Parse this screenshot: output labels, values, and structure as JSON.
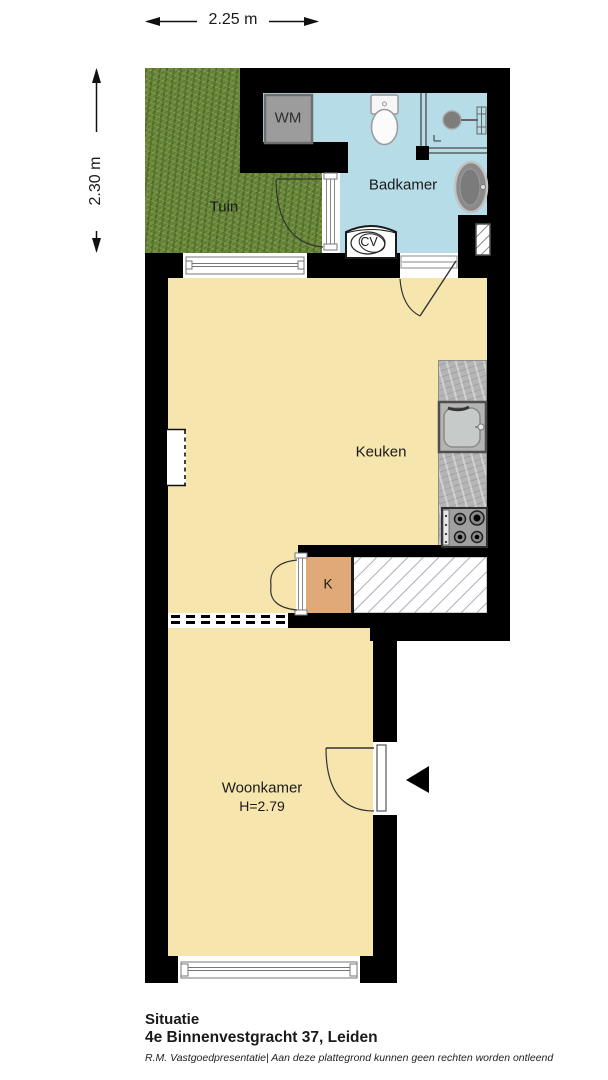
{
  "dimensions": {
    "width_label": "2.25 m",
    "height_label": "2.30 m"
  },
  "rooms": {
    "tuin": {
      "label": "Tuin"
    },
    "badkamer": {
      "label": "Badkamer"
    },
    "keuken": {
      "label": "Keuken"
    },
    "woonkamer": {
      "label": "Woonkamer",
      "height_note": "H=2.79"
    },
    "kast": {
      "label": "K"
    }
  },
  "appliances": {
    "washing_machine": "WM",
    "boiler": "CV"
  },
  "icons": {
    "entrance_arrow": "left-pointing-triangle"
  },
  "title_block": {
    "title": "Situatie",
    "address": "4e Binnenvestgracht 37, Leiden",
    "disclaimer": "R.M. Vastgoedpresentatie| Aan deze plattegrond kunnen geen rechten worden ontleend"
  },
  "colors": {
    "wall": "#000000",
    "floor_cream": "#f7e5ae",
    "bathroom_blue": "#b6dce8",
    "garden_green": "#6b8a3d",
    "closet_tan": "#e0a978",
    "counter_gray": "#b5b5b5",
    "washing_machine_gray": "#9c9c9c"
  }
}
